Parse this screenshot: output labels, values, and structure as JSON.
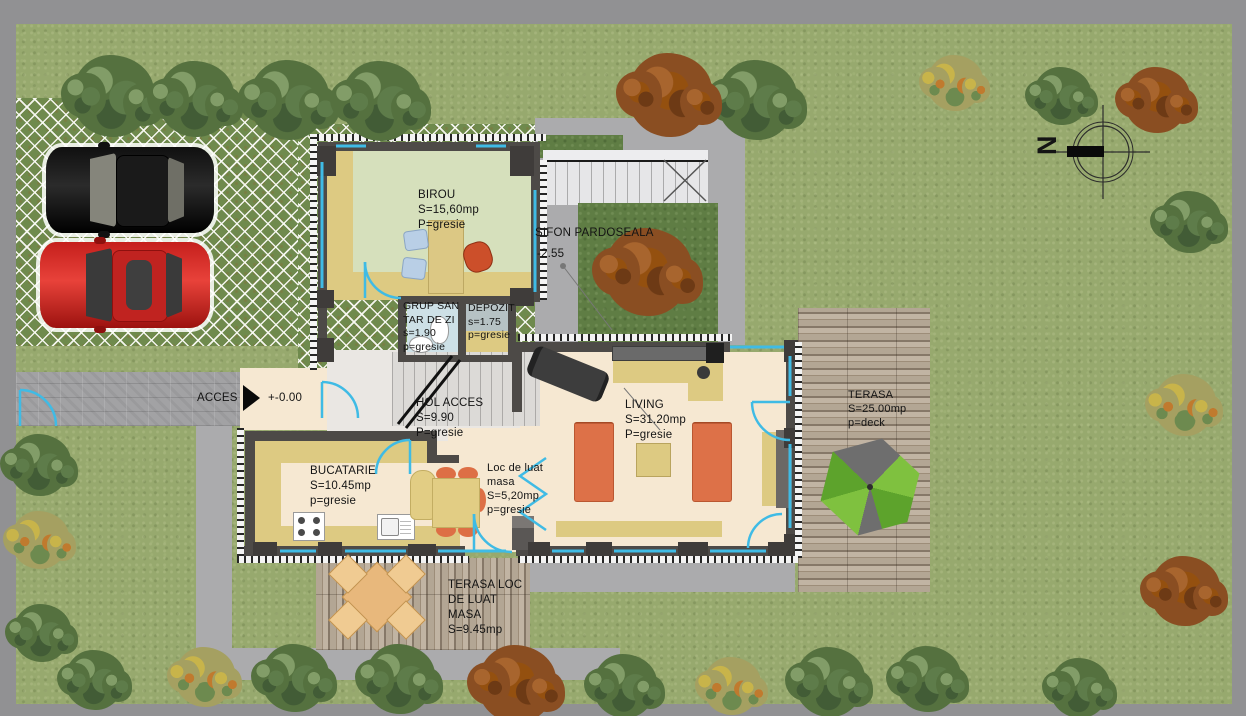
{
  "site": {
    "compass_label": "N",
    "access_label": "ACCES",
    "level_ground": "+-0.00",
    "sifon_label": "SIFON PARDOSEALA",
    "sifon_level": "-2.55"
  },
  "rooms": {
    "birou": {
      "name": "BIROU",
      "area": "S=15,60mp",
      "floor": "P=gresie"
    },
    "grup_sanitar": {
      "name_line1": "GRUP SAN",
      "name_line2": "TAR DE ZI",
      "area": "s=1.90",
      "floor": "p=gresie"
    },
    "depozit": {
      "name": "DEPOZIT",
      "area": "s=1.75",
      "floor": "p=gresie"
    },
    "hol": {
      "name": "HOL ACCES",
      "area": "S=9.90",
      "floor": "P=gresie"
    },
    "bucatarie": {
      "name": "BUCATARIE",
      "area": "S=10.45mp",
      "floor": "p=gresie"
    },
    "dining": {
      "name_line1": "Loc de luat",
      "name_line2": "masa",
      "area": "S=5,20mp",
      "floor": "p=gresie"
    },
    "living": {
      "name": "LIVING",
      "area": "S=31.20mp",
      "floor": "P=gresie"
    },
    "terasa": {
      "name": "TERASA",
      "area": "S=25.00mp",
      "floor": "p=deck"
    },
    "terasa_dining": {
      "line1": "TERASA LOC",
      "line2": "DE LUAT",
      "line3": "MASA",
      "area": "S=9.45mp"
    }
  },
  "palette": {
    "accent_cyan": "#3fbbe5",
    "wall_gray": "#4d4a47",
    "sofa_orange": "#dd7148",
    "umbrella_green": "#7fc13f",
    "car_red": "#c51f1c",
    "car_black": "#141414",
    "grass_green": "#97a96e",
    "deck_wood": "#a89a86",
    "floor_cream": "#f6e8d2"
  }
}
